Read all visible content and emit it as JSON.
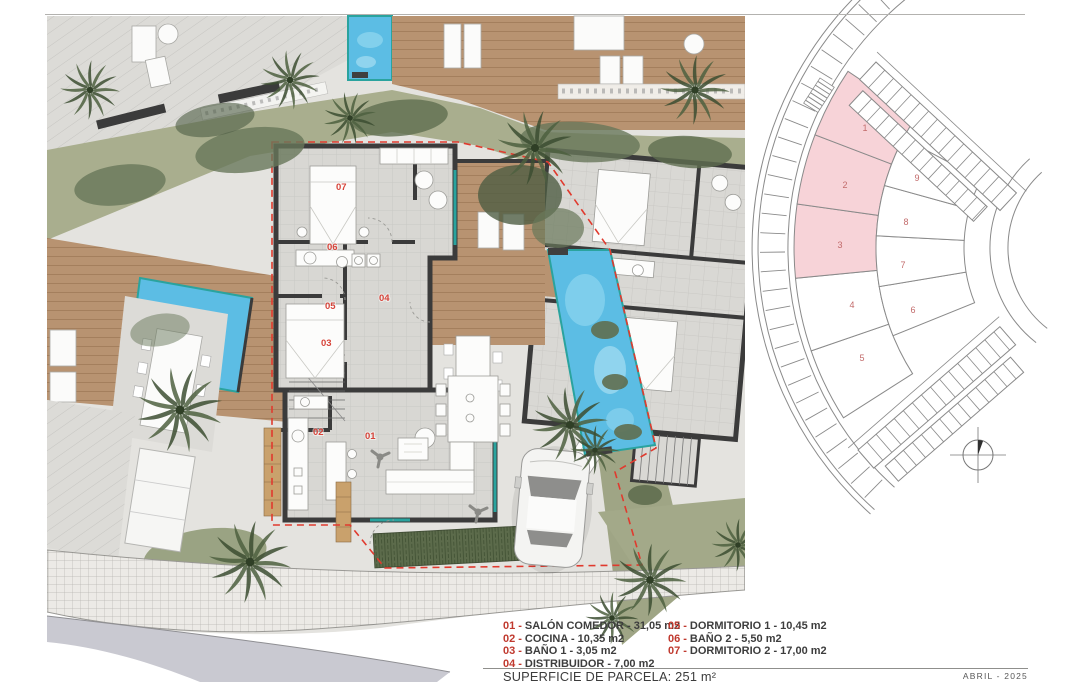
{
  "page": {
    "parcel_area_label": "SUPERFICIE DE PARCELA: 251 m²",
    "date_label": "ABRIL - 2025"
  },
  "legend": {
    "separator": "-",
    "columns": [
      {
        "items": [
          {
            "num": "01",
            "desc": "SALÓN COMEDOR - 31,05 m2"
          },
          {
            "num": "02",
            "desc": "COCINA - 10,35 m2"
          },
          {
            "num": "03",
            "desc": "BAÑO 1 - 3,05 m2"
          },
          {
            "num": "04",
            "desc": "DISTRIBUIDOR - 7,00 m2"
          }
        ]
      },
      {
        "items": [
          {
            "num": "05",
            "desc": "DORMITORIO 1 - 10,45 m2"
          },
          {
            "num": "06",
            "desc": "BAÑO 2 - 5,50 m2"
          },
          {
            "num": "07",
            "desc": "DORMITORIO 2 - 17,00 m2"
          }
        ]
      }
    ]
  },
  "floor_plan": {
    "room_labels": {
      "r01": "01",
      "r02": "02",
      "r03": "03",
      "r04": "04",
      "r05": "05",
      "r06": "06",
      "r07": "07"
    }
  },
  "site_plan": {
    "highlight_color": "#f7d3d8",
    "plots": [
      {
        "label": "1",
        "highlighted": true
      },
      {
        "label": "2",
        "highlighted": true
      },
      {
        "label": "3",
        "highlighted": true
      },
      {
        "label": "4",
        "highlighted": false
      },
      {
        "label": "5",
        "highlighted": false
      },
      {
        "label": "6",
        "highlighted": false
      },
      {
        "label": "7",
        "highlighted": false
      },
      {
        "label": "8",
        "highlighted": false
      },
      {
        "label": "9",
        "highlighted": false
      }
    ]
  },
  "colors": {
    "legend_number_red": "#c0392e",
    "room_label_red": "#d6443a",
    "parcel_boundary_red": "#e03a2e",
    "pool_blue": "#5cbde4",
    "deck_wood": "#b89371",
    "vegetation": "#a9ae8e",
    "wall_dark": "#3b3b3b"
  }
}
